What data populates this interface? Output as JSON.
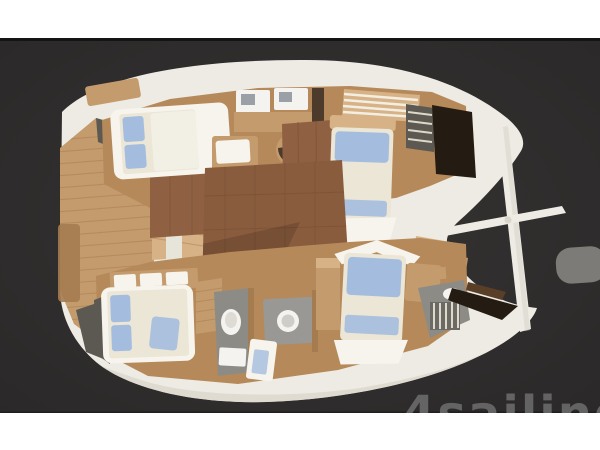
{
  "scene": {
    "description": "Top-view 3D rendering of a catamaran sailing yacht interior deck plan, bow to the right, on a dark gray backdrop between white bands",
    "watermark": {
      "text": "4sailing"
    },
    "areas": [
      "aft cockpit deck",
      "port aft cabin with double bed",
      "galley with twin sinks",
      "port forward cabin with double bed",
      "companionway stairs",
      "main salon",
      "starboard aft cabin with double bed",
      "aft head with toilet",
      "mid head with round basin and shower",
      "starboard forward cabin with double bed",
      "forward head with louvered steps",
      "forward crossbeam",
      "bowsprit spar"
    ]
  },
  "colors": {
    "band_white": "#ffffff",
    "divider": "#141414",
    "bg_center": "#363333",
    "bg_edge": "#2a2828",
    "hull": "#edebe3",
    "hull_shadow": "#d9d5cb",
    "wood": "#c49b6c",
    "wood_light": "#d7b286",
    "wood_dark": "#a57c50",
    "wall_wood": "#b5895a",
    "salon_floor": "#8a5c3e",
    "cabin_floor": "#8f6142",
    "tile_line": "#754e33",
    "duvet": "#ebe6d6",
    "sheet_white": "#f6f4ec",
    "pillow_blue": "#a4bddf",
    "gray_floor": "#8d8b85",
    "gray_counter": "#9a9894",
    "fixture_white": "#f4f3ef",
    "glass_dark": "#241c12",
    "steps_dark": "#5c5952",
    "board_gray": "#7d7b77",
    "watermark_gray": "#6e6e6e"
  }
}
